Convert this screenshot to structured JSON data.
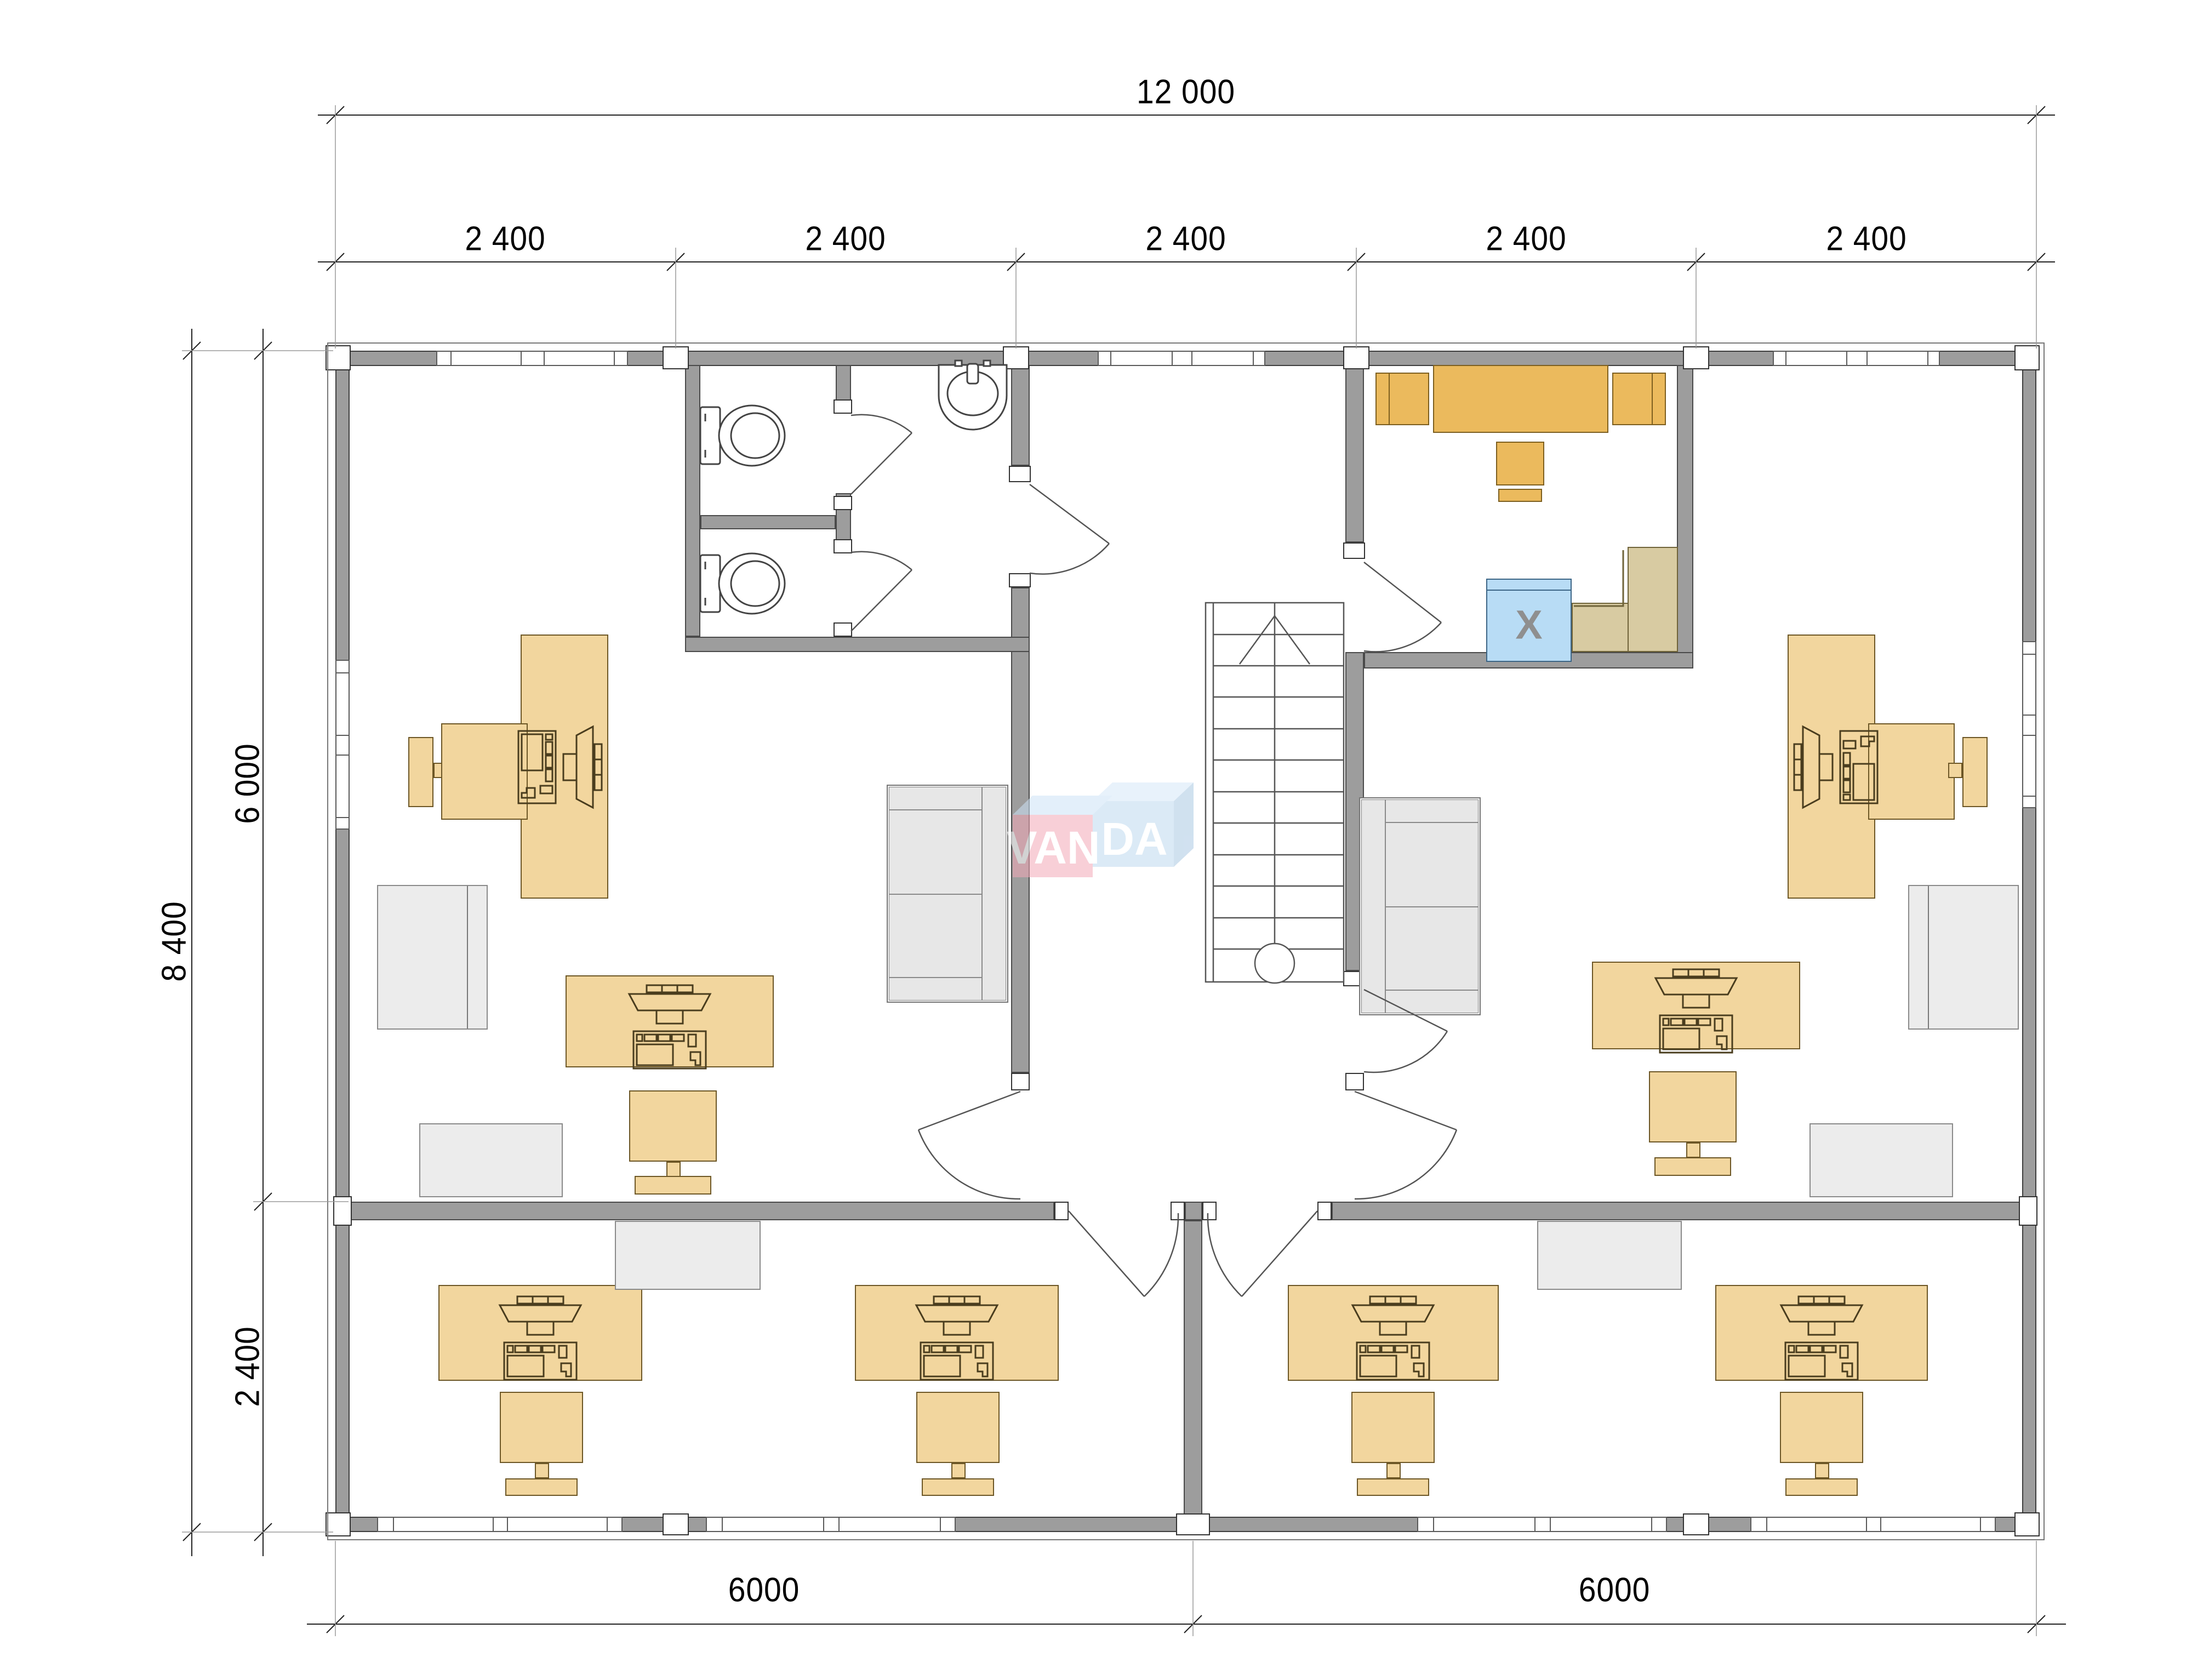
{
  "dims": {
    "total_width": "12 000",
    "modules": [
      "2 400",
      "2 400",
      "2 400",
      "2 400",
      "2 400"
    ],
    "total_height": "8 400",
    "upper": "6 000",
    "lower": "2 400",
    "bottom": [
      "6000",
      "6000"
    ]
  },
  "watermark": {
    "left": "VAN",
    "right": "DA"
  },
  "appliance": {
    "label": "X"
  },
  "colors": {
    "wall": "#9d9d9d",
    "desk": "#f2d69e",
    "kitchen_furniture": "#ebba5d",
    "appliance_blue": "#b8dcf5",
    "counter": "#d8cba2",
    "gray_furniture": "#ececec",
    "watermark_pink": "#f4a9b8",
    "watermark_blue": "#bed9ef"
  }
}
